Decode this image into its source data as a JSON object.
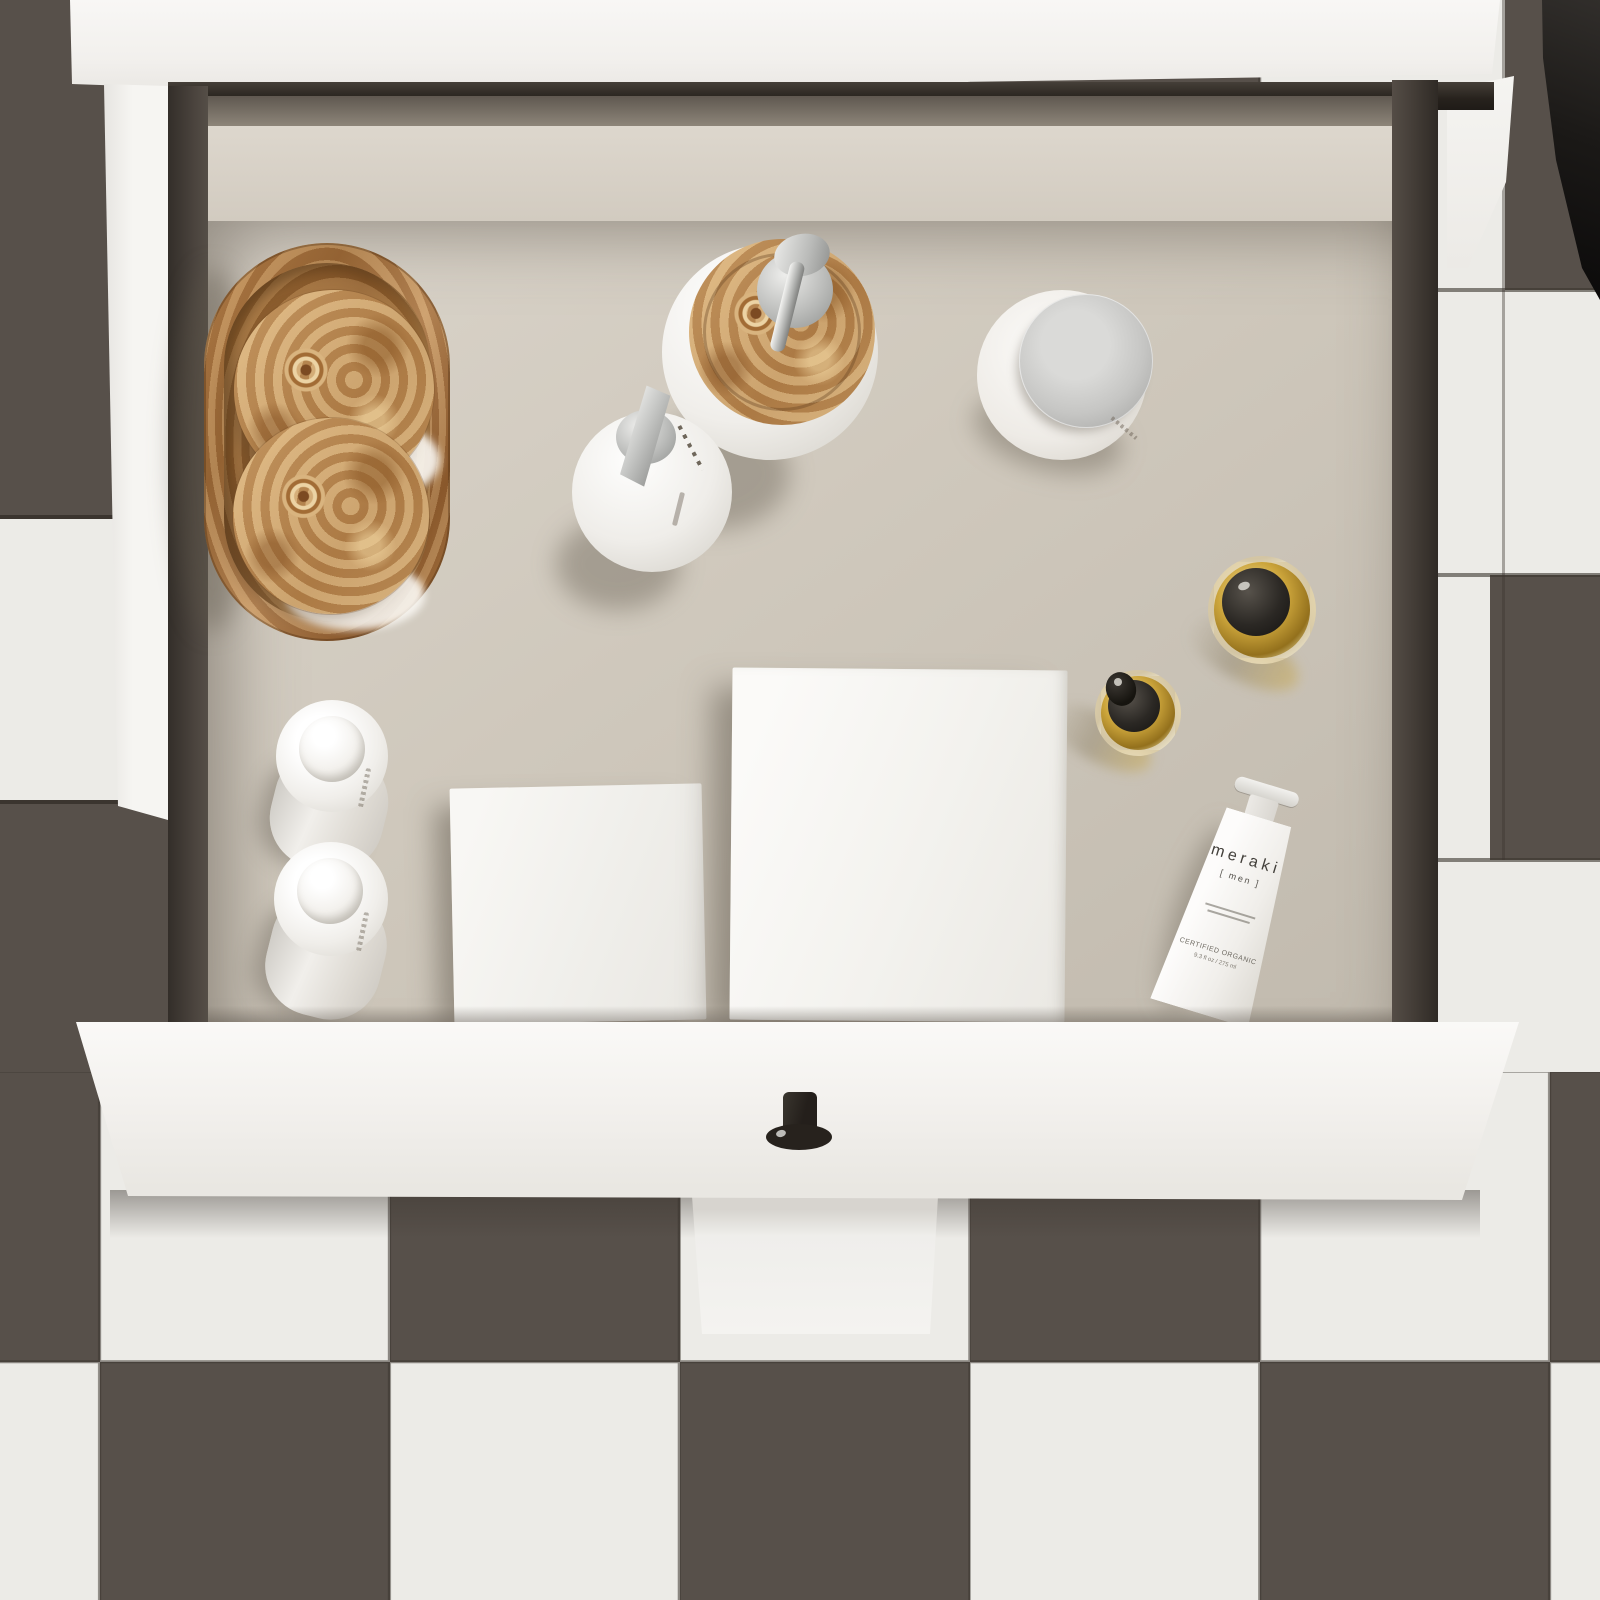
{
  "scene": {
    "description": "Top-down view of an open white bathroom vanity drawer organized with toiletries, on a dark-and-white checkerboard tiled floor",
    "objects": [
      "oval burl-wood tray",
      "two burl-wood lidded glass canisters",
      "soap dispenser with burl-wood lid and chrome pump",
      "white pump bottle with chrome nozzle",
      "white cream jar with chrome lid",
      "small amber glass dropper bottle",
      "large amber glass dropper bottle",
      "meraki men cosmetic tube",
      "two white dome-capped lotion bottles",
      "two white storage boxes",
      "black drawer knob",
      "dark towel draped at top right"
    ]
  },
  "floor": {
    "pattern": "checkerboard",
    "tile_size_px": 290
  },
  "colors": {
    "tile_dark": "#57504a",
    "tile_light": "#ecebe7",
    "grout": "#3b352f",
    "cabinet_white": "#f5f4f1",
    "drawer_interior": "#cdc6ba",
    "drawer_wall": "#453f39",
    "wood_light": "#dab277",
    "wood_dark": "#8a5a2e",
    "chrome": "#bfc0be",
    "amber": "#c7a13a",
    "cap_black": "#23201c",
    "towel_black": "#171513"
  },
  "products": {
    "meraki": {
      "brand": "meraki",
      "variant": "[ men ]",
      "certified": "CERTIFIED ORGANIC",
      "volume": "9.3 fl oz / 275 ml"
    }
  }
}
